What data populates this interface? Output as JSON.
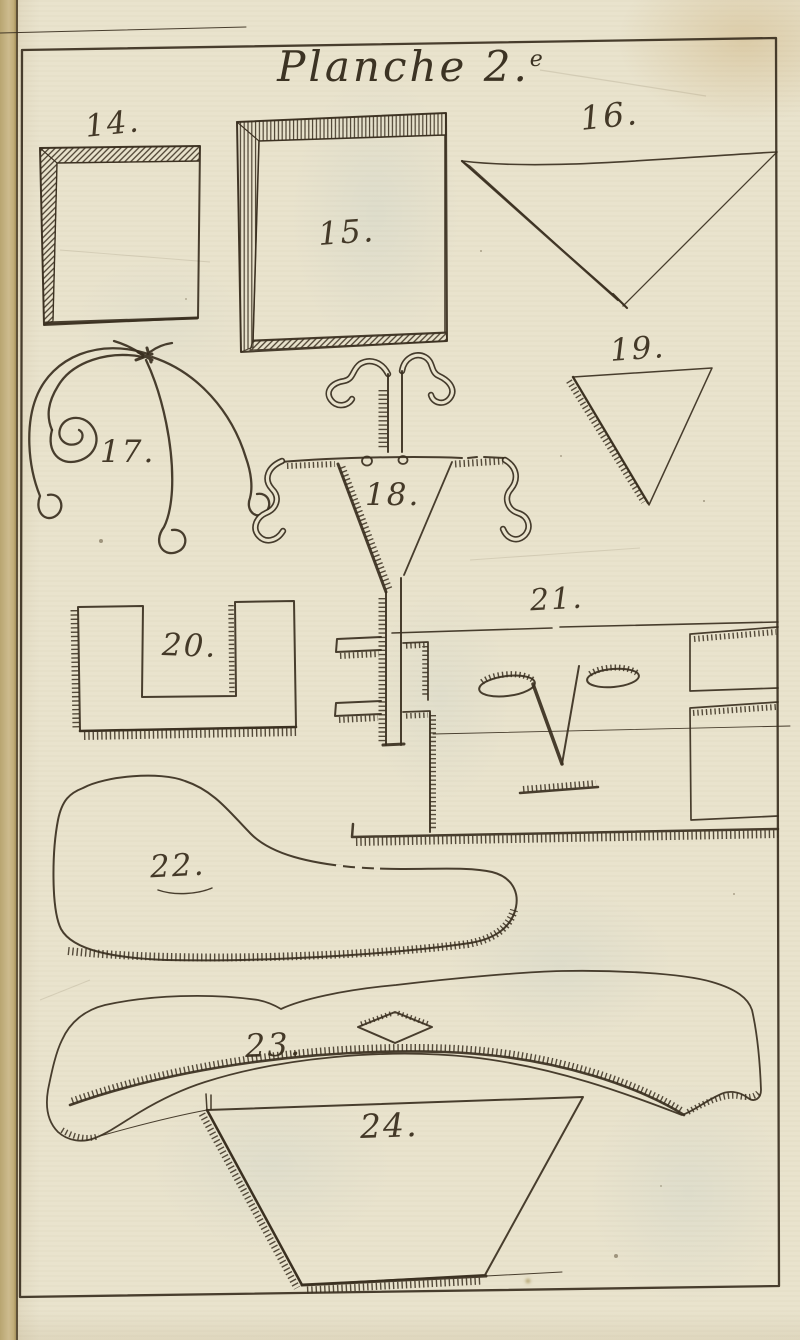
{
  "title": {
    "main": "Planche 2.",
    "sup": "e"
  },
  "figures": [
    {
      "label": "14."
    },
    {
      "label": "15."
    },
    {
      "label": "16."
    },
    {
      "label": "17."
    },
    {
      "label": "18."
    },
    {
      "label": "19."
    },
    {
      "label": "20."
    },
    {
      "label": "21."
    },
    {
      "label": "22."
    },
    {
      "label": "23."
    },
    {
      "label": "24."
    }
  ],
  "colors": {
    "paper": "#e9e3cd",
    "ink": "#3a2f20",
    "page_edge": "#c2ad7c"
  }
}
